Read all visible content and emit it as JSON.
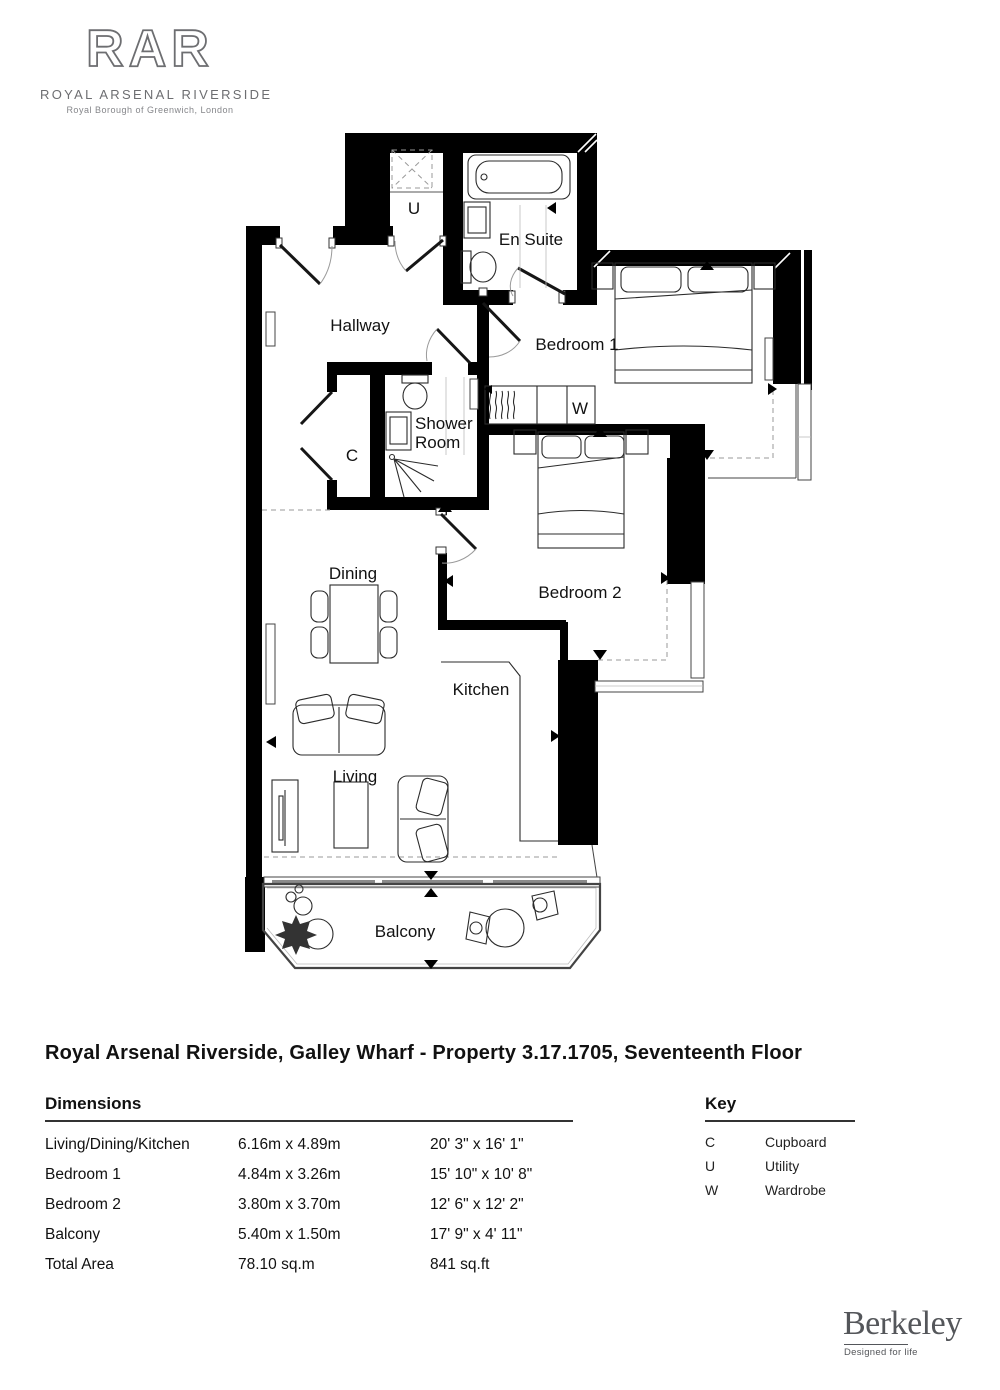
{
  "page": {
    "background": "#ffffff"
  },
  "logo": {
    "monogram": "RAR",
    "name": "ROYAL ARSENAL RIVERSIDE",
    "tagline": "Royal Borough of Greenwich, London",
    "color": "#6d6e71"
  },
  "plan_title": "Royal Arsenal Riverside, Galley Wharf - Property 3.17.1705, Seventeenth Floor",
  "floorplan": {
    "wall_color": "#000000",
    "rooms": {
      "hallway": "Hallway",
      "utility_abbr": "U",
      "ensuite": "En Suite",
      "bedroom1": "Bedroom 1",
      "shower_line1": "Shower",
      "shower_line2": "Room",
      "cupboard_abbr": "C",
      "wardrobe_abbr": "W",
      "bedroom2": "Bedroom 2",
      "dining": "Dining",
      "kitchen": "Kitchen",
      "living": "Living",
      "balcony": "Balcony"
    }
  },
  "dimensions": {
    "heading": "Dimensions",
    "rows": [
      {
        "name": "Living/Dining/Kitchen",
        "metric": "6.16m x 4.89m",
        "imperial": "20' 3\" x 16' 1\""
      },
      {
        "name": "Bedroom 1",
        "metric": "4.84m x 3.26m",
        "imperial": "15' 10\" x 10' 8\""
      },
      {
        "name": "Bedroom 2",
        "metric": "3.80m x 3.70m",
        "imperial": "12' 6\" x 12' 2\""
      },
      {
        "name": "Balcony",
        "metric": "5.40m x 1.50m",
        "imperial": "17' 9\" x 4' 11\""
      },
      {
        "name": "Total Area",
        "metric": "78.10 sq.m",
        "imperial": "841 sq.ft"
      }
    ]
  },
  "key": {
    "heading": "Key",
    "rows": [
      {
        "abbr": "C",
        "label": "Cupboard"
      },
      {
        "abbr": "U",
        "label": "Utility"
      },
      {
        "abbr": "W",
        "label": "Wardrobe"
      }
    ]
  },
  "brand": {
    "name": "Berkeley",
    "tagline": "Designed for life",
    "color": "#54565a"
  }
}
